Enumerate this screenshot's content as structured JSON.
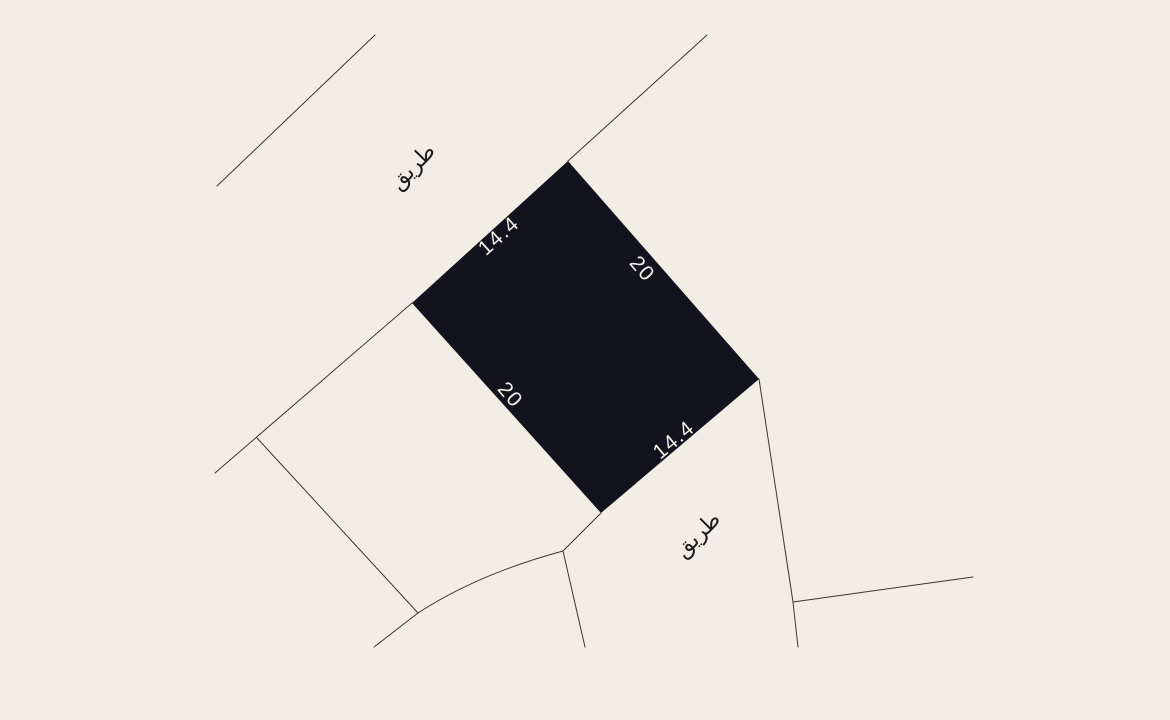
{
  "map": {
    "background_color": "#f2ede5",
    "boundary_line_color": "#3a3733",
    "plot": {
      "fill_color": "#12131d",
      "dimension_label_color": "#f2efe8",
      "dimensions": {
        "top_edge": "14.4",
        "right_edge": "20",
        "left_edge": "20",
        "bottom_edge": "14.4"
      }
    },
    "roads": {
      "top_label": "طريق",
      "bottom_label": "طريق",
      "label_color": "#1b1b1b"
    }
  }
}
